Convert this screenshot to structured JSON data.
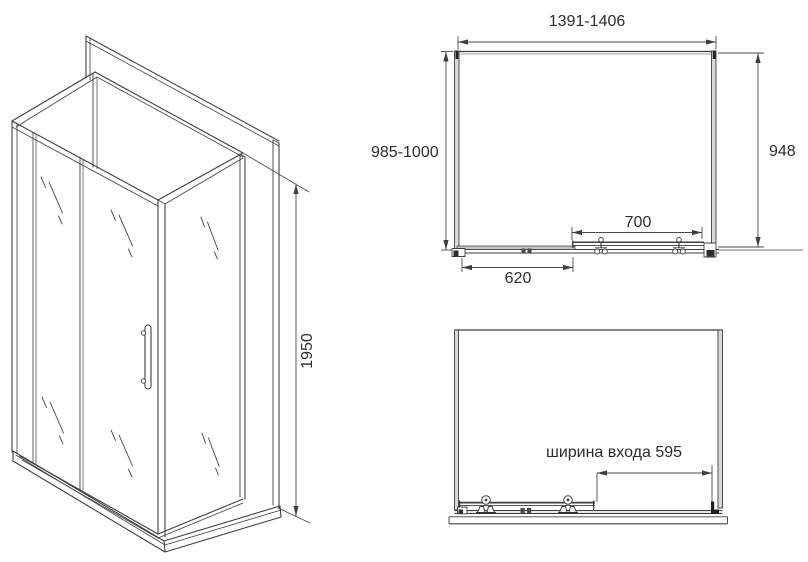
{
  "views": {
    "isometric": {
      "height_mm": "1950"
    },
    "plan": {
      "overall_width_mm": "1391-1406",
      "overall_depth_mm": "985-1000",
      "side_glass_depth_mm": "948",
      "sliding_door_width_mm": "700",
      "fixed_panel_width_mm": "620"
    },
    "front": {
      "entrance_width_label": "ширина входа 595"
    }
  },
  "colors": {
    "line": "#3f3f3f",
    "dimension_line": "#4a4a4a",
    "text": "#2c2c2c",
    "glass_fill": "#d9d9d9",
    "background": "#ffffff"
  }
}
